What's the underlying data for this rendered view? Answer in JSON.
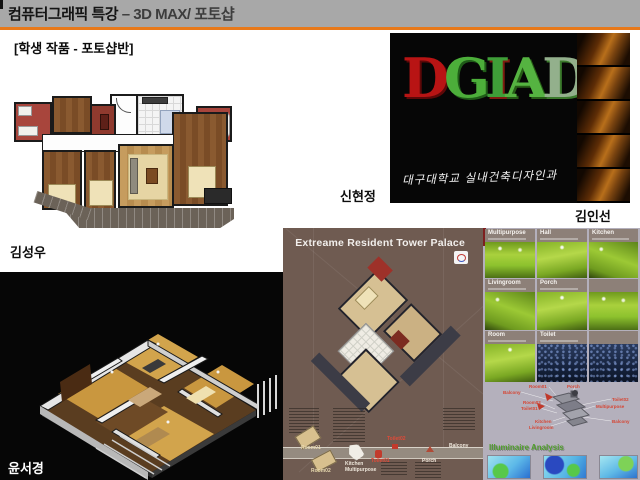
{
  "slide": {
    "header": {
      "title_main": "컴퓨터그래픽 특강",
      "title_sub": "– 3D MAX/ 포토샵",
      "accent_color": "#e8791a",
      "bar_color": "#a8a8a8"
    },
    "subtitle": "[학생 작품 - 포토샵반]"
  },
  "students": {
    "floorplan2d": "김성우",
    "dgiad_left": "신현정",
    "dgiad_right": "김인선",
    "iso3d": "윤서경"
  },
  "dgiad": {
    "letters": [
      {
        "ch": "D",
        "color": "#b81414"
      },
      {
        "ch": "G",
        "color": "#4cae3a"
      },
      {
        "ch": "I",
        "color": "#3f9e38"
      },
      {
        "ch": "A",
        "color": "#55b341"
      },
      {
        "ch": "D",
        "color": "#93b08c"
      }
    ],
    "caption": "대구대학교 실내건축디자인과"
  },
  "poster": {
    "title": "Extreame Resident Tower Palace",
    "background_color": "#6f5b51",
    "room_labels": {
      "room01": "Room01",
      "room02": "Room02",
      "kitchen": "Kitchen",
      "multipurpose": "Multipurpose",
      "toilet01": "Toilet01",
      "toilet02": "Toilet02",
      "porch": "Porch",
      "balcony": "Balcony"
    }
  },
  "gallery": {
    "row1": [
      "Multipurpose",
      "Hall",
      "Kitchen"
    ],
    "row2": [
      "Livingroom",
      "Porch"
    ],
    "row3": [
      "Room",
      "Toilet"
    ],
    "analysis_title": "Illuminaire Analysis",
    "green_color": "#8dc22e",
    "diagram_labels": {
      "room01": "Room01",
      "porch": "Porch",
      "balcony_l": "Balcony",
      "room02": "Room02",
      "toilet01": "Toilet01",
      "toilet02": "Toilet02",
      "multipurpose": "Multipurpose",
      "balcony_r": "Balcony",
      "kitchen": "Kitchen",
      "livingroom": "Livingroom"
    }
  }
}
